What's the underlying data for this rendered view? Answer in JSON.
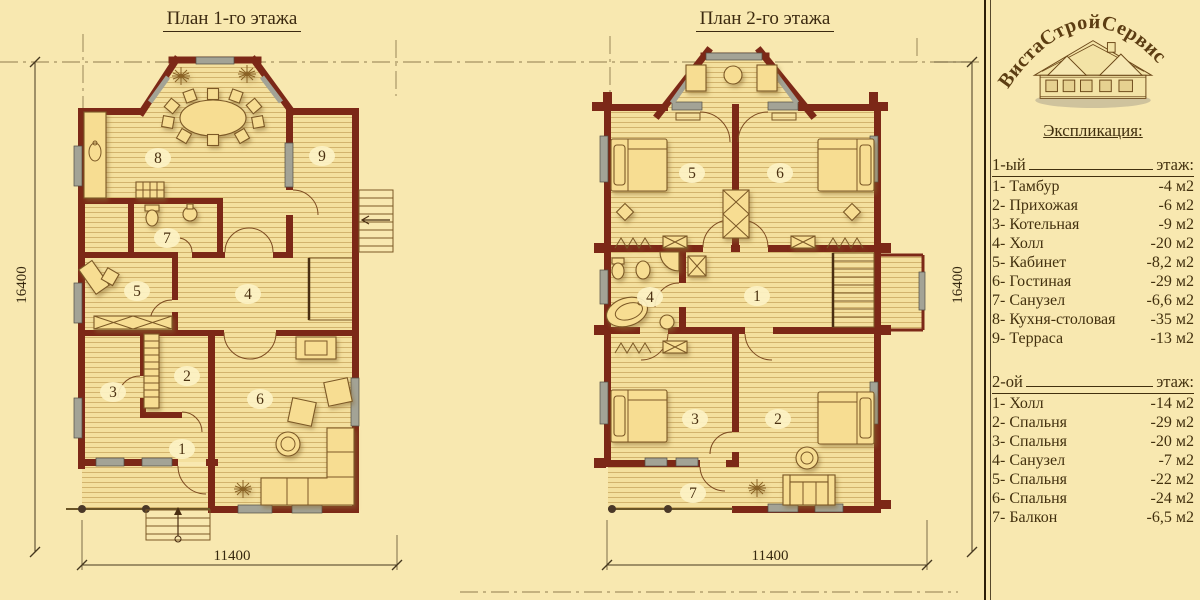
{
  "page": {
    "background": "#f8e8b0",
    "wall_color": "#7c2817",
    "text_color": "#3c2a10"
  },
  "plan1": {
    "title": "План 1-го этажа",
    "dim_width": "11400",
    "dim_height": "16400",
    "rooms": [
      "1",
      "2",
      "3",
      "4",
      "5",
      "6",
      "7",
      "8",
      "9"
    ]
  },
  "plan2": {
    "title": "План 2-го этажа",
    "dim_width": "11400",
    "dim_height": "16400",
    "rooms": [
      "1",
      "2",
      "3",
      "4",
      "5",
      "6",
      "7"
    ]
  },
  "legend": {
    "brand": "ВистаСтройСервис",
    "heading": "Экспликация:",
    "floor1": {
      "label": "1-ый",
      "suffix": "этаж:",
      "items": [
        {
          "name": "1- Тамбур",
          "area": "-4 м2"
        },
        {
          "name": "2- Прихожая",
          "area": "-6 м2"
        },
        {
          "name": "3- Котельная",
          "area": "-9 м2"
        },
        {
          "name": "4- Холл",
          "area": "-20 м2"
        },
        {
          "name": "5- Кабинет",
          "area": "-8,2 м2"
        },
        {
          "name": "6- Гостиная",
          "area": "-29 м2"
        },
        {
          "name": "7- Санузел",
          "area": "-6,6 м2"
        },
        {
          "name": "8- Кухня-столовая",
          "area": "-35 м2"
        },
        {
          "name": "9- Терраса",
          "area": "-13 м2"
        }
      ]
    },
    "floor2": {
      "label": "2-ой",
      "suffix": "этаж:",
      "items": [
        {
          "name": "1- Холл",
          "area": "-14 м2"
        },
        {
          "name": "2- Спальня",
          "area": "-29 м2"
        },
        {
          "name": "3- Спальня",
          "area": "-20 м2"
        },
        {
          "name": "4- Санузел",
          "area": "-7 м2"
        },
        {
          "name": "5- Спальня",
          "area": "-22 м2"
        },
        {
          "name": "6- Спальня",
          "area": "-24 м2"
        },
        {
          "name": "7- Балкон",
          "area": "-6,5 м2"
        }
      ]
    }
  }
}
